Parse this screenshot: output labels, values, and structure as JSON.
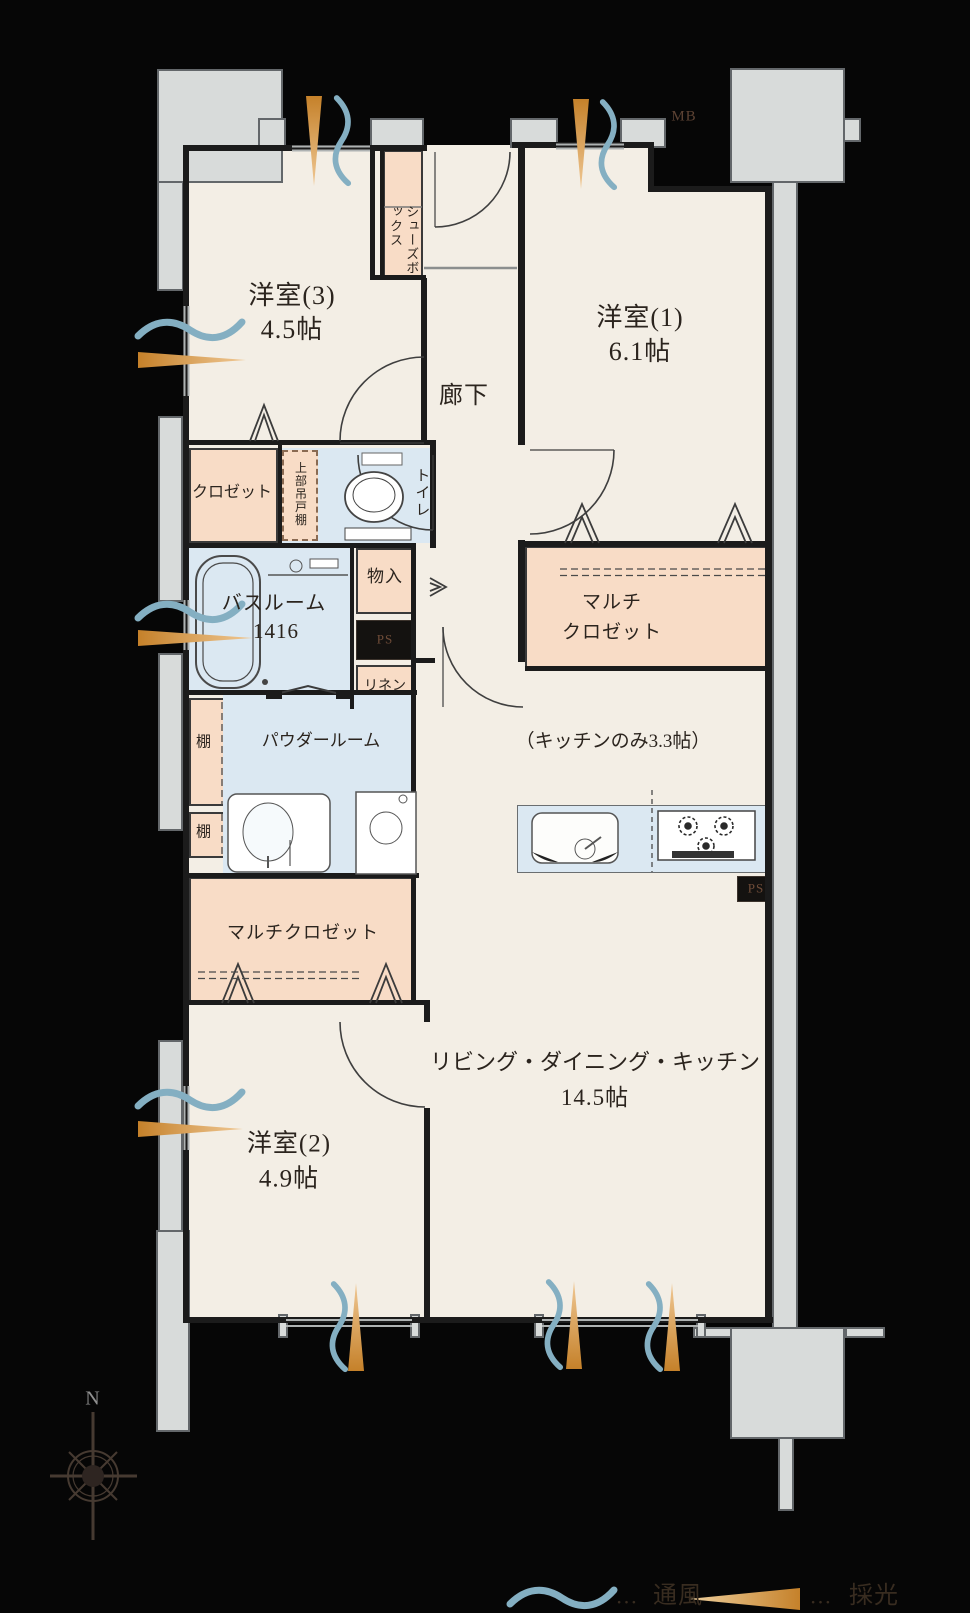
{
  "rooms": {
    "room3": {
      "name": "洋室(3)",
      "size": "4.5帖"
    },
    "room1": {
      "name": "洋室(1)",
      "size": "6.1帖"
    },
    "room2": {
      "name": "洋室(2)",
      "size": "4.9帖"
    },
    "ldk": {
      "name": "リビング・ダイニング・キッチン",
      "size": "14.5帖"
    },
    "kitchen_note": "（キッチンのみ3.3帖）",
    "hallway": "廊下",
    "bathroom": {
      "name": "バスルーム",
      "size": "1416"
    },
    "powder": "パウダールーム",
    "toilet": "トイレ",
    "closet": "クロゼット",
    "multi_closet_left": "マルチクロゼット",
    "multi_closet_right": {
      "line1": "マルチ",
      "line2": "クロゼット"
    }
  },
  "storage": {
    "shoes_box": "シューズボックス",
    "upper_cabinet": "上部吊戸棚",
    "storage": "物入",
    "linen": "リネン",
    "shelf": "棚"
  },
  "services": {
    "ps": "PS",
    "mb": "MB"
  },
  "compass": {
    "north": "N"
  },
  "legend": {
    "ventilation": "通風",
    "daylight": "採光",
    "dots": "…"
  },
  "colors": {
    "floor": "#f3eee5",
    "closet_pink": "#f8dcc6",
    "water_blue": "#dbe8f2",
    "exterior_gray": "#d8dbda",
    "wall": "#1b1b1b",
    "vent_blue": "#84afc2",
    "light_orange": "#c5812a",
    "text": "#2b241e"
  }
}
